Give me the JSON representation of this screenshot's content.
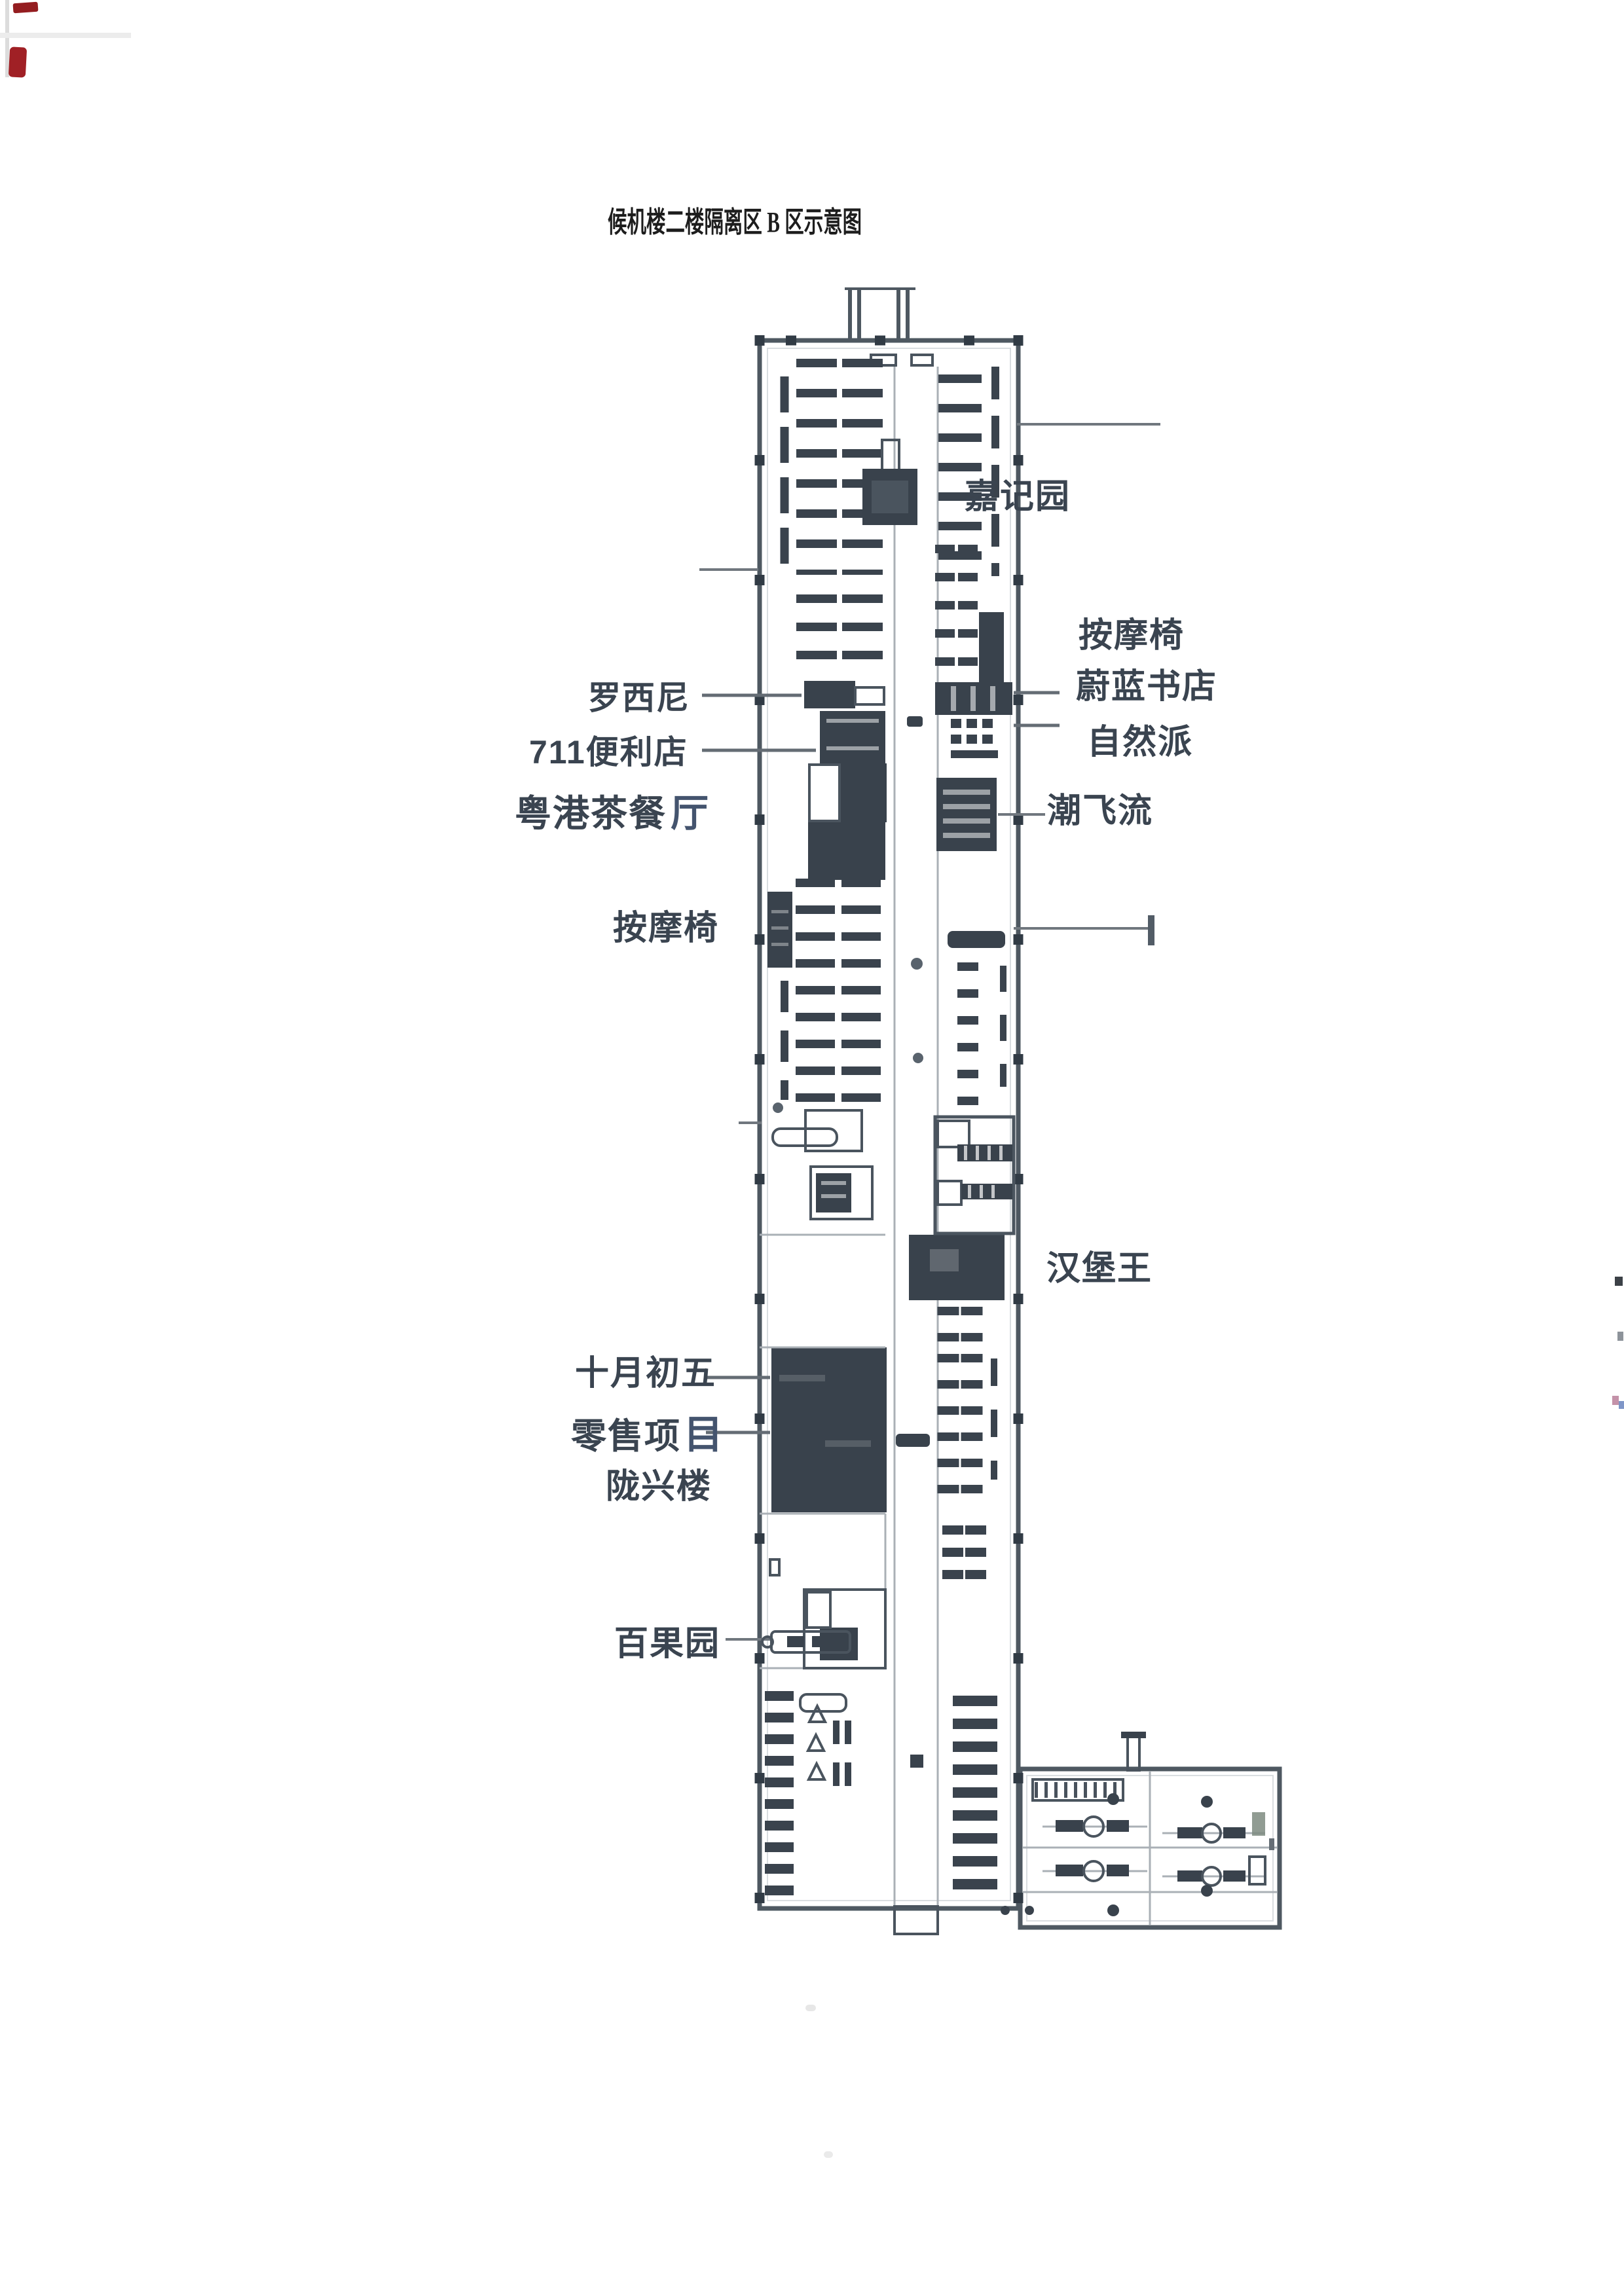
{
  "page": {
    "title": "候机楼二楼隔离区 B 区示意图"
  },
  "floor_plan": {
    "labels": {
      "jiajiyuan": "嘉记园",
      "massage_right": "按摩椅",
      "weilan_bookstore": "蔚蓝书店",
      "ziranpai": "自然派",
      "rossini": "罗西尼",
      "seven_eleven": "711便利店",
      "yuegang_prefix": "粤港茶餐",
      "yuegang_suffix": "厅",
      "chaofeiliu": "潮飞流",
      "massage_left": "按摩椅",
      "burger_king": "汉堡王",
      "shiyuechuwu": "十月初五",
      "retail_prefix": "零售项",
      "retail_suffix": "目",
      "longxinglou": "陇兴楼",
      "baiguoyuan": "百果园"
    }
  }
}
